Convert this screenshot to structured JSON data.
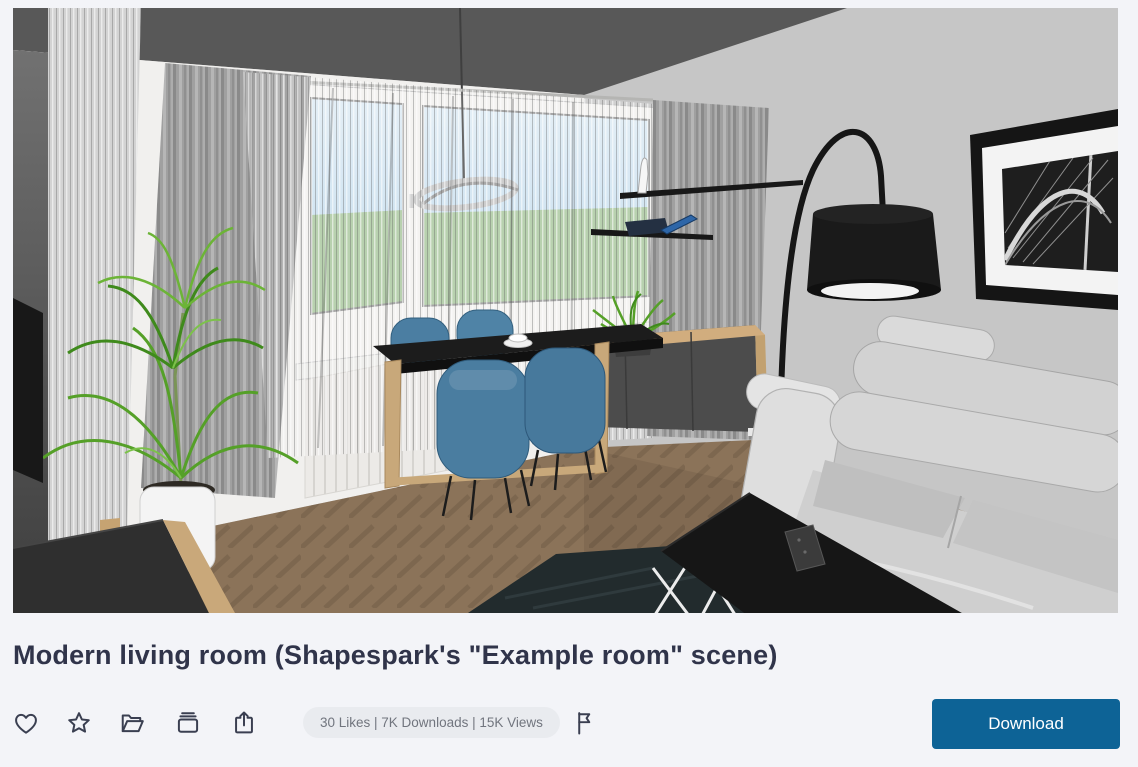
{
  "page": {
    "background_color": "#f3f4f8"
  },
  "title": "Modern living room (Shapespark's \"Example room\" scene)",
  "preview": {
    "type": "3d-room-render-thumbnail",
    "description": "Architectural 3D render of a modern living room: dining table with four blue chairs by a large curtained window, chrome pendant lamp, black arc floor lamp, light gray fabric sofa, black coffee table with white wire legs and a remote on it, wooden sideboard with dark fronts, wall shelves holding a phone and a figurine, framed black-and-white bridge photo, tall green potted plant, dark TV cabinet, brown parquet floor, dark rug.",
    "palette": {
      "ceiling": "#585858",
      "right_wall": "#c6c6c6",
      "back_wall": "#f1f0ee",
      "floor": "#8b7359",
      "window_sky": "#badaef",
      "window_field": "#a6c79a",
      "chairs": "#4a7da0",
      "sofa": "#d5d5d5",
      "plant": "#55a028",
      "wood": "#cfab7d"
    }
  },
  "actions": {
    "like_icon": "heart-outline",
    "favorite_icon": "star-outline",
    "folder_icon": "open-folder-outline",
    "collection_icon": "archive-outline",
    "share_icon": "share-box-arrow-outline",
    "report_icon": "flag-outline"
  },
  "stats": {
    "text": "30 Likes | 7K Downloads | 15K Views",
    "likes": "30",
    "downloads": "7K",
    "views": "15K"
  },
  "download_button": {
    "label": "Download",
    "color": "#0d6396"
  }
}
